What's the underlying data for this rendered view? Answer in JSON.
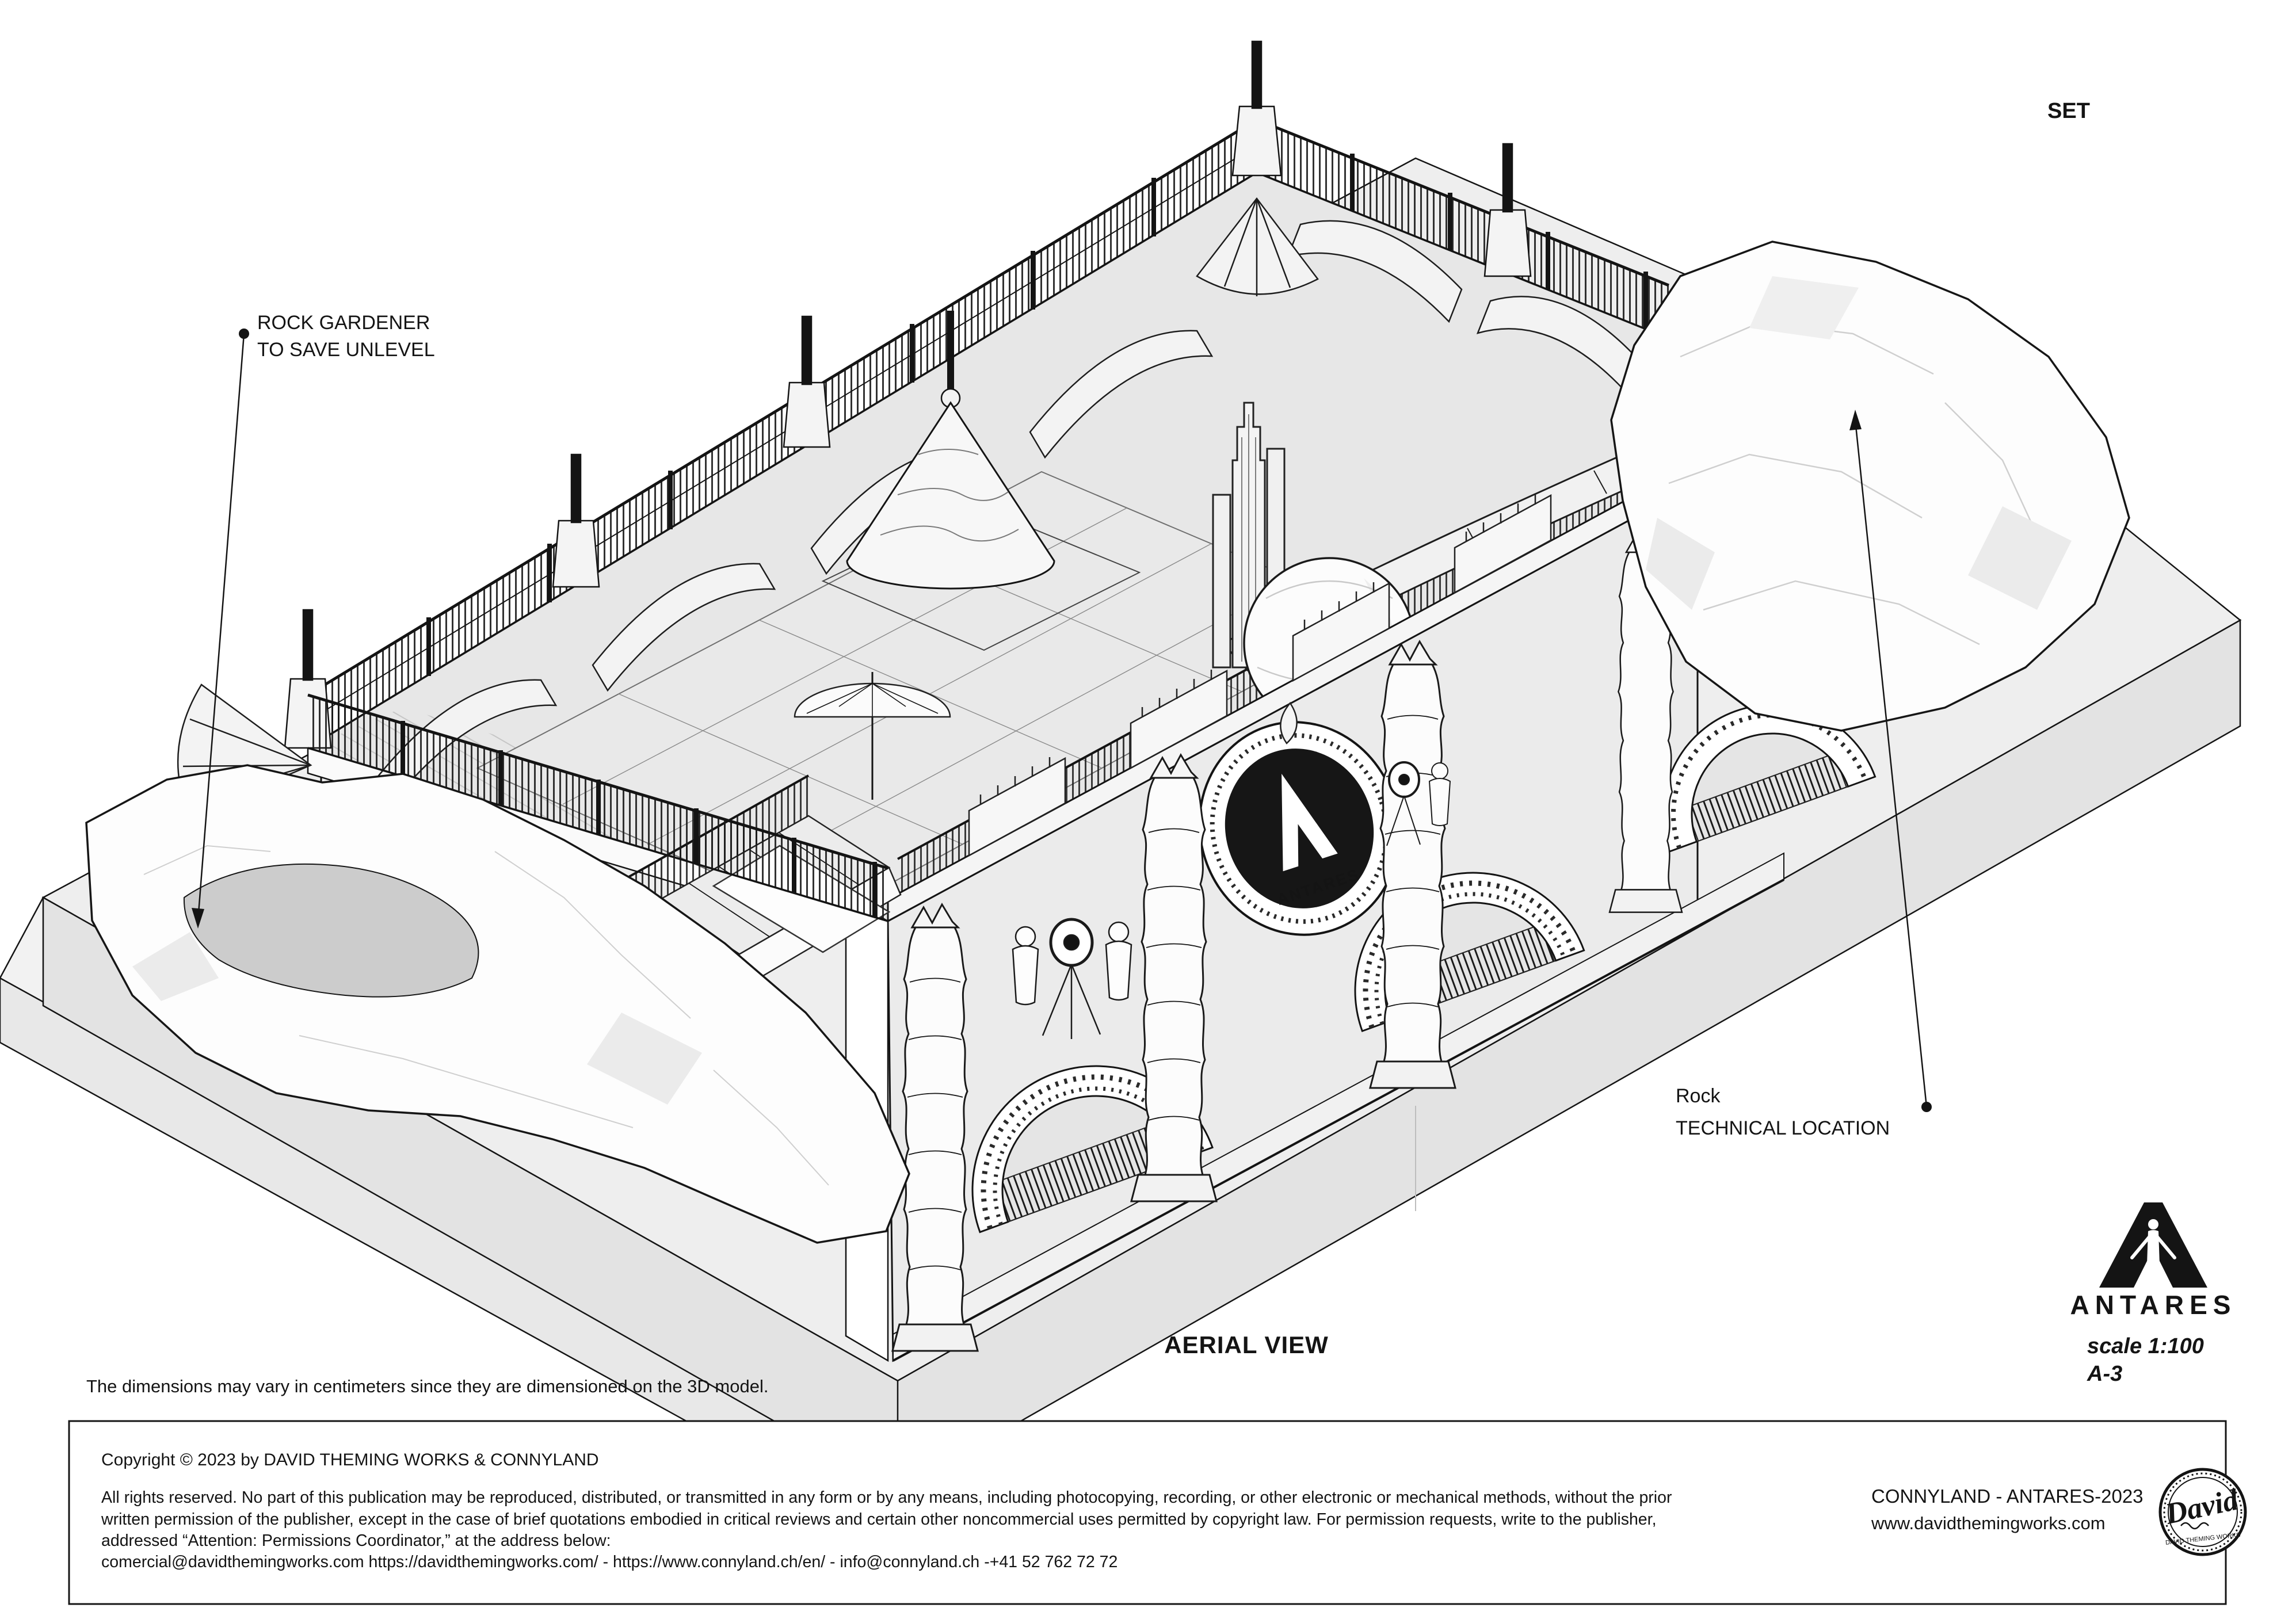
{
  "colors": {
    "paper": "#ffffff",
    "line": "#141414",
    "platform_top": "#eeeeee",
    "platform_side": "#e3e3e3",
    "deck": "#e7e7e7",
    "wall": "#ebebeb",
    "pool": "#cccccc",
    "fence": "#1b1b1b",
    "medallion": "#161616"
  },
  "annotations": {
    "set_label": "SET",
    "rock_gardener_line1": "ROCK GARDENER",
    "rock_gardener_line2": "TO SAVE UNLEVEL",
    "rock_technical_line1": "Rock",
    "rock_technical_line2": "TECHNICAL LOCATION",
    "view_label": "AERIAL VIEW",
    "disclaimer": "The dimensions may vary in centimeters since they are dimensioned on the 3D model."
  },
  "facade_sign": {
    "brand": "ANTARES"
  },
  "title_block": {
    "logo_word": "ANTARES",
    "scale_label": "scale 1:100",
    "sheet_number": "A-3",
    "copyright_line": "Copyright © 2023 by DAVID THEMING WORKS & CONNYLAND",
    "rights_line1": "All rights reserved. No part of this publication may be reproduced, distributed, or transmitted in any form or by any means, including photocopying, recording, or other electronic or mechanical methods, without the prior",
    "rights_line2": "written permission of the publisher, except in the case of brief quotations embodied in critical reviews and certain other noncommercial uses permitted by copyright law. For permission requests, write to the publisher,",
    "rights_line3": "addressed “Attention: Permissions Coordinator,” at the address below:",
    "rights_line4": "comercial@davidthemingworks.com https://davidthemingworks.com/  -  https://www.connyland.ch/en/ - info@connyland.ch -+41 52 762 72 72",
    "project_label": "CONNYLAND - ANTARES-2023",
    "website": "www.davidthemingworks.com",
    "stamp_name": "David",
    "stamp_ring_text": "DAVID THEMING WORKS"
  }
}
